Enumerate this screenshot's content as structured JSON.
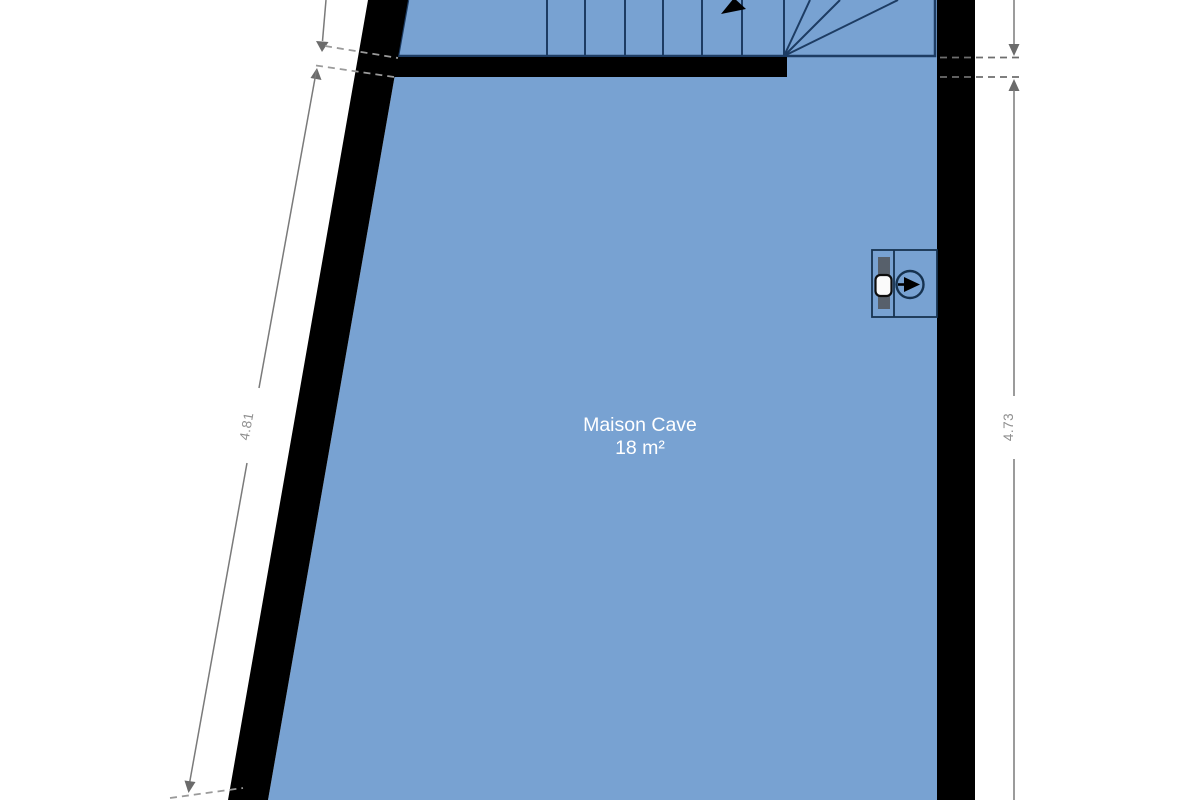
{
  "room": {
    "name": "Maison Cave",
    "area": "18 m²"
  },
  "dimensions": {
    "left": "4.81",
    "right": "4.73"
  },
  "colors": {
    "floor": "#78a2d2",
    "wall": "#000000",
    "stair_line": "#1d3c63",
    "dimension_line": "#7a7a7a",
    "dimension_text": "#8f8f8f",
    "room_label_text": "#ffffff"
  },
  "symbols": {
    "stairs": {
      "name": "staircase with winder steps",
      "straight_treads": 7
    },
    "fixture": {
      "name": "boiler / meter wall symbol"
    }
  }
}
